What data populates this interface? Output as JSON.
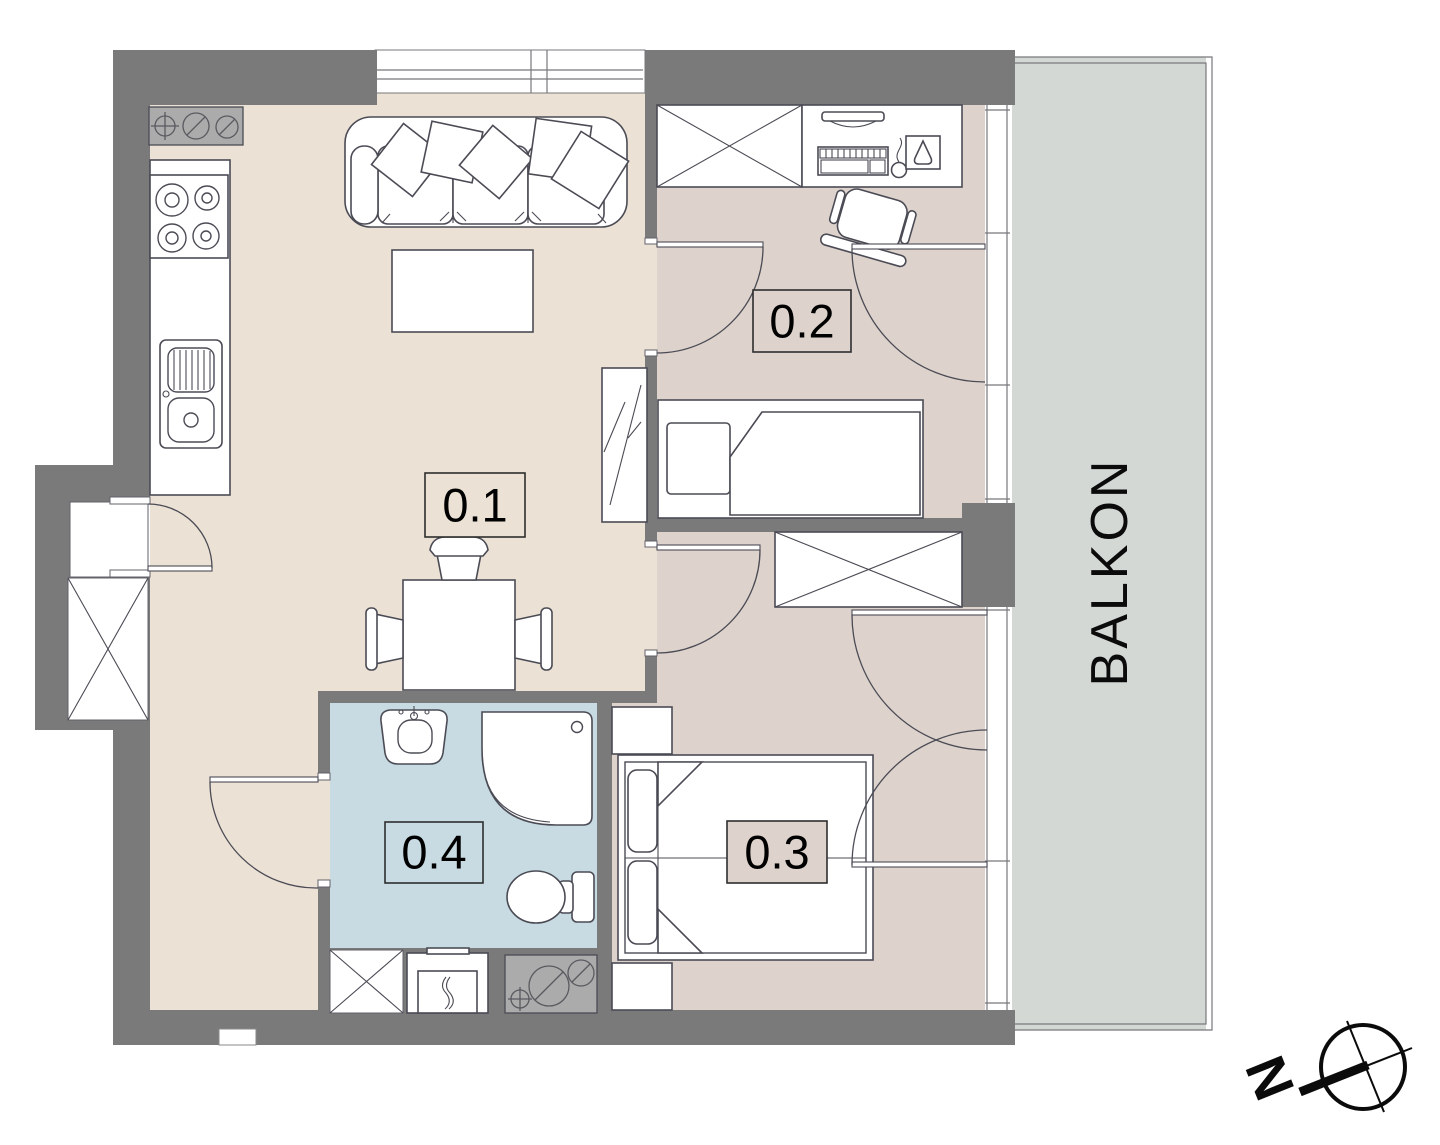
{
  "plan": {
    "title": "Apartment floor plan",
    "rooms": [
      {
        "id": "0.1",
        "label": "0.1",
        "type": "living-room-with-kitchen"
      },
      {
        "id": "0.2",
        "label": "0.2",
        "type": "bedroom-office"
      },
      {
        "id": "0.3",
        "label": "0.3",
        "type": "bedroom"
      },
      {
        "id": "0.4",
        "label": "0.4",
        "type": "bathroom"
      }
    ],
    "balcony": {
      "label": "BALKON"
    },
    "compass": {
      "north_label": "N"
    },
    "colors": {
      "wall": "#7a7a7a",
      "living": "#ebe1d5",
      "room": "#ddd3cc",
      "bath": "#c9dbe2",
      "balcony": "#d3d8d4",
      "utility": "#ababab",
      "line": "#4b4b55"
    }
  }
}
